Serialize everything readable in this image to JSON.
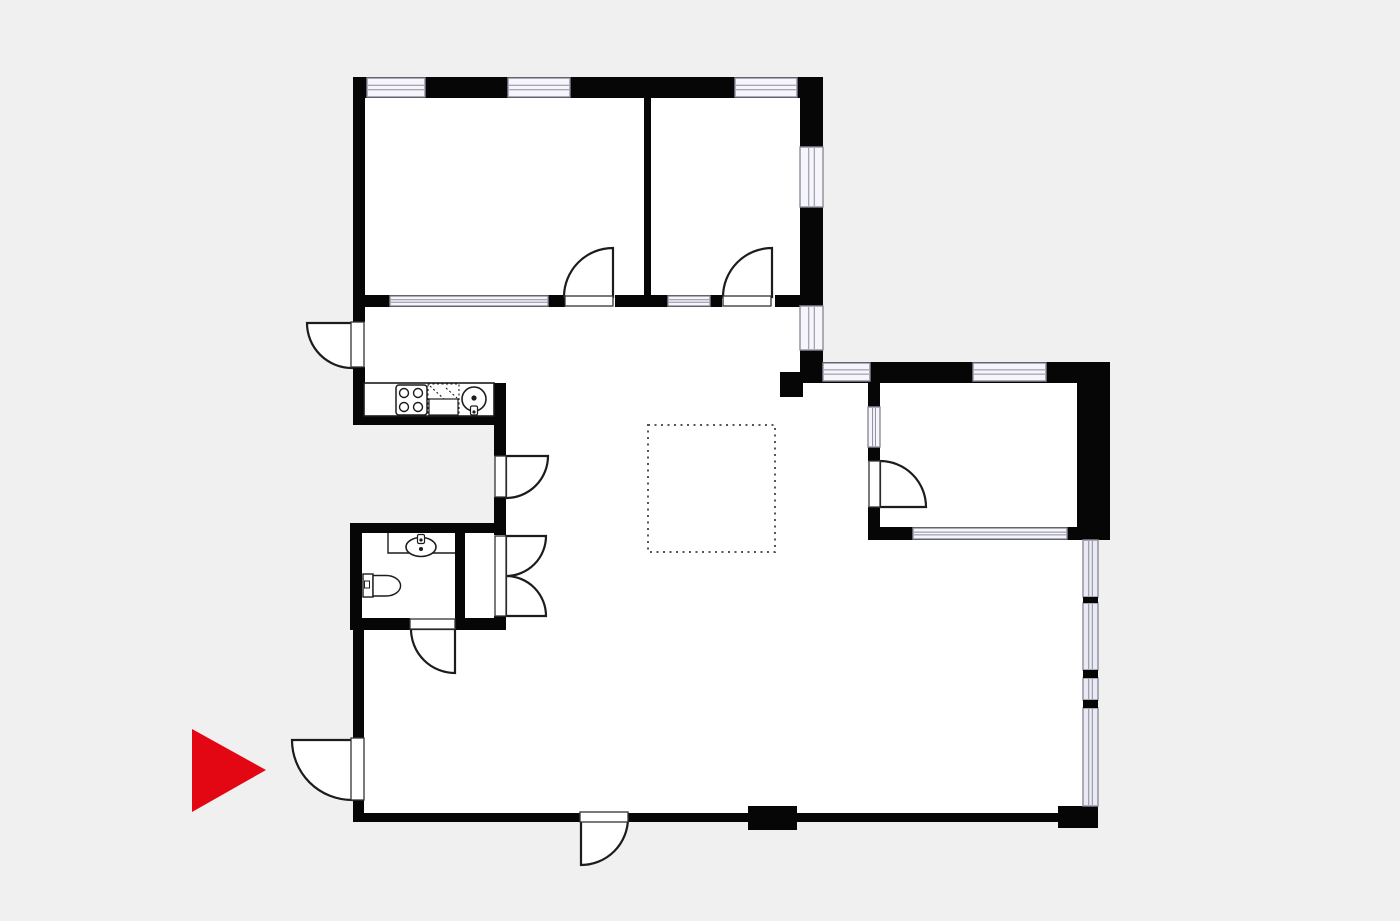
{
  "canvas": {
    "width": 1400,
    "height": 921
  },
  "colors": {
    "background": "#f0f0f0",
    "floor": "#ffffff",
    "wall": "#060606",
    "window_fill": "#f5f5fb",
    "window_border": "#8d8d9c",
    "glass_fill": "#e9eaf3",
    "stroke": "#1c1c1c",
    "dotted": "#555555",
    "arrow": "#e30613",
    "threshold_border": "#333333"
  },
  "plan": {
    "floors": [
      {
        "n": "floor-bedrooms",
        "t": "rect",
        "x": 356,
        "y": 79,
        "w": 467,
        "h": 229,
        "f": "floor"
      },
      {
        "n": "floor-hall-upper",
        "t": "rect",
        "x": 356,
        "y": 297,
        "w": 467,
        "h": 86,
        "f": "floor"
      },
      {
        "n": "floor-kitchen",
        "t": "rect",
        "x": 356,
        "y": 383,
        "w": 138,
        "h": 41,
        "f": "floor"
      },
      {
        "n": "floor-living-mid",
        "t": "rect",
        "x": 506,
        "y": 383,
        "w": 577,
        "h": 157,
        "f": "floor"
      },
      {
        "n": "floor-living-lower",
        "t": "rect",
        "x": 506,
        "y": 540,
        "w": 592,
        "h": 280,
        "f": "floor"
      },
      {
        "n": "floor-bath-hall",
        "t": "rect",
        "x": 356,
        "y": 523,
        "w": 150,
        "h": 297,
        "f": "floor"
      },
      {
        "n": "floor-right-room",
        "t": "rect",
        "x": 823,
        "y": 362,
        "w": 287,
        "h": 178,
        "f": "floor"
      }
    ],
    "walls": [
      {
        "n": "wall-top",
        "t": "rect",
        "x": 353,
        "y": 77,
        "w": 470,
        "h": 21,
        "f": "wall"
      },
      {
        "n": "wall-left-upper",
        "t": "rect",
        "x": 353,
        "y": 77,
        "w": 12,
        "h": 245,
        "f": "wall"
      },
      {
        "n": "wall-left-mid",
        "t": "rect",
        "x": 353,
        "y": 367,
        "w": 12,
        "h": 58,
        "f": "wall"
      },
      {
        "n": "wall-right-upper-section",
        "t": "rect",
        "x": 800,
        "y": 77,
        "w": 23,
        "h": 306,
        "f": "wall"
      },
      {
        "n": "wall-bedroom-divider",
        "t": "rect",
        "x": 644,
        "y": 98,
        "w": 7,
        "h": 199,
        "f": "wall"
      },
      {
        "n": "wall-bedrooms-south-a",
        "t": "rect",
        "x": 353,
        "y": 295,
        "w": 212,
        "h": 12,
        "f": "wall"
      },
      {
        "n": "wall-bedrooms-south-b",
        "t": "rect",
        "x": 615,
        "y": 295,
        "w": 107,
        "h": 12,
        "f": "wall"
      },
      {
        "n": "wall-bedrooms-south-c",
        "t": "rect",
        "x": 775,
        "y": 295,
        "w": 48,
        "h": 12,
        "f": "wall"
      },
      {
        "n": "wall-kitchen-south",
        "t": "rect",
        "x": 353,
        "y": 416,
        "w": 153,
        "h": 9,
        "f": "wall"
      },
      {
        "n": "wall-kitchen-east-a",
        "t": "rect",
        "x": 494,
        "y": 383,
        "w": 12,
        "h": 73,
        "f": "wall"
      },
      {
        "n": "wall-kitchen-east-b",
        "t": "rect",
        "x": 494,
        "y": 497,
        "w": 12,
        "h": 38,
        "f": "wall"
      },
      {
        "n": "wall-kitchen-east-c",
        "t": "rect",
        "x": 494,
        "y": 616,
        "w": 12,
        "h": 14,
        "f": "wall"
      },
      {
        "n": "wall-bath-north",
        "t": "rect",
        "x": 350,
        "y": 523,
        "w": 156,
        "h": 10,
        "f": "wall"
      },
      {
        "n": "wall-bath-west",
        "t": "rect",
        "x": 350,
        "y": 523,
        "w": 12,
        "h": 107,
        "f": "wall"
      },
      {
        "n": "wall-bath-east",
        "t": "rect",
        "x": 455,
        "y": 533,
        "w": 10,
        "h": 85,
        "f": "wall"
      },
      {
        "n": "wall-bath-south-a",
        "t": "rect",
        "x": 350,
        "y": 618,
        "w": 60,
        "h": 12,
        "f": "wall"
      },
      {
        "n": "wall-bath-south-b",
        "t": "rect",
        "x": 455,
        "y": 618,
        "w": 51,
        "h": 12,
        "f": "wall"
      },
      {
        "n": "wall-left-lower-a",
        "t": "rect",
        "x": 353,
        "y": 630,
        "w": 11,
        "h": 108,
        "f": "wall"
      },
      {
        "n": "wall-left-lower-b",
        "t": "rect",
        "x": 353,
        "y": 800,
        "w": 11,
        "h": 20,
        "f": "wall"
      },
      {
        "n": "wall-bottom-a",
        "t": "rect",
        "x": 353,
        "y": 813,
        "w": 227,
        "h": 9,
        "f": "wall"
      },
      {
        "n": "wall-bottom-b",
        "t": "rect",
        "x": 628,
        "y": 813,
        "w": 430,
        "h": 9,
        "f": "wall"
      },
      {
        "n": "pier-bottom-1",
        "t": "rect",
        "x": 748,
        "y": 806,
        "w": 49,
        "h": 24,
        "f": "wall"
      },
      {
        "n": "pier-bottom-2",
        "t": "rect",
        "x": 1058,
        "y": 806,
        "w": 40,
        "h": 22,
        "f": "wall"
      },
      {
        "n": "wall-rightroom-north",
        "t": "rect",
        "x": 823,
        "y": 362,
        "w": 287,
        "h": 21,
        "f": "wall"
      },
      {
        "n": "wall-rightroom-east",
        "t": "rect",
        "x": 1077,
        "y": 362,
        "w": 33,
        "h": 178,
        "f": "wall"
      },
      {
        "n": "wall-rightroom-west-a",
        "t": "rect",
        "x": 868,
        "y": 383,
        "w": 12,
        "h": 78,
        "f": "wall"
      },
      {
        "n": "wall-rightroom-west-b",
        "t": "rect",
        "x": 868,
        "y": 507,
        "w": 12,
        "h": 33,
        "f": "wall"
      },
      {
        "n": "wall-rightroom-south",
        "t": "rect",
        "x": 868,
        "y": 527,
        "w": 242,
        "h": 13,
        "f": "wall"
      },
      {
        "n": "pier-living-corner",
        "t": "rect",
        "x": 780,
        "y": 372,
        "w": 23,
        "h": 25,
        "f": "wall"
      }
    ],
    "windows": [
      {
        "n": "window-top-1",
        "t": "window",
        "x": 367,
        "y": 78,
        "w": 58,
        "h": 19,
        "dir": "h"
      },
      {
        "n": "window-top-2",
        "t": "window",
        "x": 508,
        "y": 78,
        "w": 62,
        "h": 19,
        "dir": "h"
      },
      {
        "n": "window-top-3",
        "t": "window",
        "x": 735,
        "y": 78,
        "w": 62,
        "h": 19,
        "dir": "h"
      },
      {
        "n": "window-east-bedroom2-a",
        "t": "window",
        "x": 800,
        "y": 147,
        "w": 23,
        "h": 60,
        "dir": "v"
      },
      {
        "n": "window-east-bedroom2-b",
        "t": "window",
        "x": 800,
        "y": 306,
        "w": 23,
        "h": 44,
        "dir": "v"
      },
      {
        "n": "window-glazed-partition",
        "t": "window",
        "x": 390,
        "y": 296,
        "w": 158,
        "h": 10,
        "dir": "h"
      },
      {
        "n": "window-hall-partition",
        "t": "window",
        "x": 668,
        "y": 296,
        "w": 42,
        "h": 10,
        "dir": "h"
      },
      {
        "n": "window-rightroom-north-1",
        "t": "window",
        "x": 823,
        "y": 363,
        "w": 47,
        "h": 18,
        "dir": "h"
      },
      {
        "n": "window-rightroom-north-2",
        "t": "window",
        "x": 973,
        "y": 363,
        "w": 73,
        "h": 18,
        "dir": "h"
      },
      {
        "n": "window-rightroom-west",
        "t": "window",
        "x": 868,
        "y": 407,
        "w": 12,
        "h": 40,
        "dir": "v"
      },
      {
        "n": "window-rightroom-south",
        "t": "window",
        "x": 913,
        "y": 528,
        "w": 154,
        "h": 11,
        "dir": "h"
      },
      {
        "n": "glass-pane-1",
        "t": "window",
        "x": 1083,
        "y": 540,
        "w": 15,
        "h": 57,
        "dir": "v",
        "g": true
      },
      {
        "n": "glass-pane-2",
        "t": "window",
        "x": 1083,
        "y": 603,
        "w": 15,
        "h": 67,
        "dir": "v",
        "g": true
      },
      {
        "n": "glass-pane-3",
        "t": "window",
        "x": 1083,
        "y": 678,
        "w": 15,
        "h": 22,
        "dir": "v",
        "g": true
      },
      {
        "n": "glass-pane-4",
        "t": "window",
        "x": 1083,
        "y": 708,
        "w": 15,
        "h": 98,
        "dir": "v",
        "g": true
      }
    ],
    "mullions": [
      {
        "n": "glass-mullion-1",
        "t": "rect",
        "x": 1083,
        "y": 597,
        "w": 15,
        "h": 6,
        "f": "wall"
      },
      {
        "n": "glass-mullion-2",
        "t": "rect",
        "x": 1083,
        "y": 670,
        "w": 15,
        "h": 8,
        "f": "wall"
      },
      {
        "n": "glass-mullion-3",
        "t": "rect",
        "x": 1083,
        "y": 700,
        "w": 15,
        "h": 8,
        "f": "wall"
      }
    ],
    "doors": [
      {
        "n": "door-swing-bedroom-1",
        "t": "path",
        "d": "M613,297 L564,297 A49,49 0 0 1 613,248 Z",
        "f": "floor",
        "s": "stroke",
        "sw": 2.2
      },
      {
        "n": "door-swing-bedroom-2",
        "t": "path",
        "d": "M772,297 L723,297 A49,49 0 0 1 772,248 Z",
        "f": "floor",
        "s": "stroke",
        "sw": 2.2
      },
      {
        "n": "door-swing-hall-exterior",
        "t": "path",
        "d": "M352,323 L307,323 A45,45 0 0 0 352,368 Z",
        "f": "floor",
        "s": "stroke",
        "sw": 2.2
      },
      {
        "n": "door-swing-kitchen-hall",
        "t": "path",
        "d": "M506,456 L548,456 A42,42 0 0 1 506,498 Z",
        "f": "floor",
        "s": "stroke",
        "sw": 2.2
      },
      {
        "n": "door-swing-closet-upper",
        "t": "path",
        "d": "M506,536 L546,536 A40,40 0 0 1 506,576 Z",
        "f": "floor",
        "s": "stroke",
        "sw": 2.2
      },
      {
        "n": "door-swing-closet-lower",
        "t": "path",
        "d": "M506,616 L546,616 A40,40 0 0 0 506,576 Z",
        "f": "floor",
        "s": "stroke",
        "sw": 2.2
      },
      {
        "n": "door-swing-bathroom",
        "t": "path",
        "d": "M455,629 L411,629 A44,44 0 0 0 455,673 Z",
        "f": "floor",
        "s": "stroke",
        "sw": 2.2
      },
      {
        "n": "door-swing-entrance",
        "t": "path",
        "d": "M352,740 L292,740 A60,60 0 0 0 352,800 Z",
        "f": "floor",
        "s": "stroke",
        "sw": 2.2
      },
      {
        "n": "door-swing-terrace",
        "t": "path",
        "d": "M581,818 L581,865 A47,47 0 0 0 628,818 Z",
        "f": "floor",
        "s": "stroke",
        "sw": 2.2
      },
      {
        "n": "door-swing-right-room",
        "t": "path",
        "d": "M880,507 L880,461 A46,46 0 0 1 926,507 Z",
        "f": "floor",
        "s": "stroke",
        "sw": 2.2
      }
    ],
    "thresholds": [
      {
        "n": "door-leaf-bedroom-1",
        "t": "rect",
        "x": 565,
        "y": 296,
        "w": 48,
        "h": 10,
        "f": "floor",
        "s": "threshold_border",
        "sw": 1.3
      },
      {
        "n": "door-leaf-bedroom-2",
        "t": "rect",
        "x": 723,
        "y": 296,
        "w": 48,
        "h": 10,
        "f": "floor",
        "s": "threshold_border",
        "sw": 1.3
      },
      {
        "n": "door-leaf-hall-exterior",
        "t": "rect",
        "x": 351,
        "y": 322,
        "w": 13,
        "h": 45,
        "f": "floor",
        "s": "threshold_border",
        "sw": 1.3
      },
      {
        "n": "door-leaf-kitchen-hall",
        "t": "rect",
        "x": 495,
        "y": 456,
        "w": 11,
        "h": 41,
        "f": "floor",
        "s": "threshold_border",
        "sw": 1.3
      },
      {
        "n": "door-leaf-closet",
        "t": "rect",
        "x": 495,
        "y": 536,
        "w": 11,
        "h": 80,
        "f": "floor",
        "s": "threshold_border",
        "sw": 1.3
      },
      {
        "n": "door-leaf-bathroom",
        "t": "rect",
        "x": 410,
        "y": 619,
        "w": 45,
        "h": 10,
        "f": "floor",
        "s": "threshold_border",
        "sw": 1.3
      },
      {
        "n": "door-leaf-entrance",
        "t": "rect",
        "x": 351,
        "y": 738,
        "w": 13,
        "h": 62,
        "f": "floor",
        "s": "threshold_border",
        "sw": 1.3
      },
      {
        "n": "door-leaf-terrace",
        "t": "rect",
        "x": 580,
        "y": 812,
        "w": 48,
        "h": 10,
        "f": "floor",
        "s": "threshold_border",
        "sw": 1.3
      },
      {
        "n": "door-leaf-right-room",
        "t": "rect",
        "x": 869,
        "y": 461,
        "w": 11,
        "h": 46,
        "f": "floor",
        "s": "threshold_border",
        "sw": 1.3
      }
    ],
    "fixtures": [
      {
        "n": "kitchen-counter",
        "t": "rect",
        "x": 364,
        "y": 383,
        "w": 130,
        "h": 33,
        "f": "floor",
        "s": "stroke",
        "sw": 1.6
      },
      {
        "n": "stove",
        "t": "rect",
        "x": 396,
        "y": 385,
        "w": 31,
        "h": 30,
        "rx": 3,
        "f": "floor",
        "s": "stroke",
        "sw": 1.5
      },
      {
        "n": "stove-burner-1",
        "t": "circle",
        "cx": 404,
        "cy": 393,
        "r": 4.5,
        "f": "floor",
        "s": "stroke",
        "sw": 1.4
      },
      {
        "n": "stove-burner-2",
        "t": "circle",
        "cx": 418,
        "cy": 393,
        "r": 4.5,
        "f": "floor",
        "s": "stroke",
        "sw": 1.4
      },
      {
        "n": "stove-burner-3",
        "t": "circle",
        "cx": 404,
        "cy": 407,
        "r": 4.5,
        "f": "floor",
        "s": "stroke",
        "sw": 1.4
      },
      {
        "n": "stove-burner-4",
        "t": "circle",
        "cx": 418,
        "cy": 407,
        "r": 4.5,
        "f": "floor",
        "s": "stroke",
        "sw": 1.4
      },
      {
        "n": "dishwasher-outline",
        "t": "rect",
        "x": 428,
        "y": 384,
        "w": 31,
        "h": 31,
        "f": "none",
        "s": "stroke",
        "sw": 1.1,
        "dash": "2 2.5"
      },
      {
        "n": "dishwasher-diagonal-1",
        "t": "path",
        "d": "M430,386 L444,399",
        "f": "none",
        "s": "stroke",
        "sw": 1.1,
        "dash": "2 2.5"
      },
      {
        "n": "dishwasher-diagonal-2",
        "t": "path",
        "d": "M446,388 L457,398",
        "f": "none",
        "s": "stroke",
        "sw": 1.1,
        "dash": "2 2.5"
      },
      {
        "n": "dishwasher-front",
        "t": "rect",
        "x": 429,
        "y": 399,
        "w": 29,
        "h": 16,
        "f": "floor",
        "s": "stroke",
        "sw": 1.2
      },
      {
        "n": "kitchen-sink",
        "t": "circle",
        "cx": 474,
        "cy": 399,
        "r": 12,
        "f": "floor",
        "s": "stroke",
        "sw": 1.6
      },
      {
        "n": "kitchen-sink-drain",
        "t": "circle",
        "cx": 474,
        "cy": 398,
        "r": 2.6,
        "f": "stroke",
        "s": "none",
        "sw": 0
      },
      {
        "n": "kitchen-sink-faucet",
        "t": "rect",
        "x": 470.5,
        "y": 406,
        "w": 7,
        "h": 9,
        "rx": 1.5,
        "f": "floor",
        "s": "stroke",
        "sw": 1.2
      },
      {
        "n": "kitchen-faucet-dot",
        "t": "circle",
        "cx": 474,
        "cy": 412,
        "r": 1.6,
        "f": "stroke",
        "s": "none",
        "sw": 0
      },
      {
        "n": "vanity-counter",
        "t": "path",
        "d": "M388,533 L388,553 L455,553",
        "f": "none",
        "s": "stroke",
        "sw": 1.4
      },
      {
        "n": "wash-basin",
        "t": "ellipse",
        "cx": 421,
        "cy": 547,
        "rx": 15,
        "ry": 9.5,
        "f": "floor",
        "s": "stroke",
        "sw": 1.6
      },
      {
        "n": "wash-basin-drain",
        "t": "circle",
        "cx": 421,
        "cy": 549,
        "r": 2,
        "f": "stroke",
        "s": "none",
        "sw": 0
      },
      {
        "n": "wash-basin-faucet",
        "t": "rect",
        "x": 417.5,
        "y": 534.5,
        "w": 7,
        "h": 9,
        "rx": 1.5,
        "f": "floor",
        "s": "stroke",
        "sw": 1.2
      },
      {
        "n": "basin-faucet-dot",
        "t": "circle",
        "cx": 421,
        "cy": 540,
        "r": 1.6,
        "f": "stroke",
        "s": "none",
        "sw": 0
      },
      {
        "n": "toilet-tank",
        "t": "rect",
        "x": 363,
        "y": 574,
        "w": 10,
        "h": 23,
        "f": "floor",
        "s": "stroke",
        "sw": 1.4
      },
      {
        "n": "toilet-tank-button",
        "t": "rect",
        "x": 364.5,
        "y": 581,
        "w": 5,
        "h": 7,
        "f": "floor",
        "s": "stroke",
        "sw": 1
      },
      {
        "n": "toilet-bowl",
        "t": "path",
        "d": "M373,575.5 L386,575.5 A14.5,10.2 0 0 1 386,596 L373,596 Z",
        "f": "floor",
        "s": "stroke",
        "sw": 1.4
      }
    ],
    "annotations": [
      {
        "n": "island-dotted-outline",
        "t": "rect",
        "x": 648,
        "y": 425,
        "w": 127,
        "h": 127,
        "f": "none",
        "s": "dotted",
        "sw": 2,
        "dash": "2 4.5"
      },
      {
        "n": "entrance-pointer-arrow",
        "t": "polygon",
        "pts": "192,729 192,812 266,770",
        "f": "arrow",
        "s": "none",
        "sw": 0
      }
    ]
  }
}
